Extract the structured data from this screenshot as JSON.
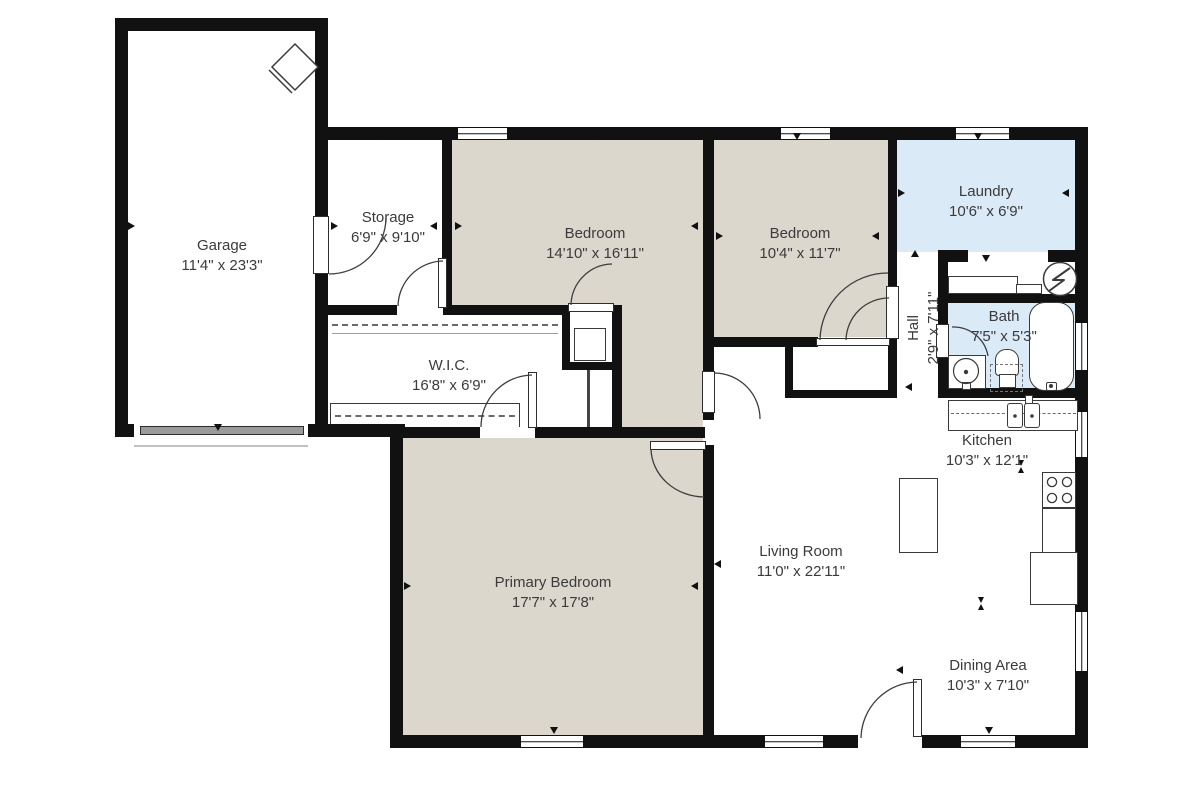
{
  "title": "Single-story house floor plan",
  "colors": {
    "wall": "#111111",
    "beige": "#dcd7cd",
    "blue": "#daeaf7",
    "text": "#3b3b3b",
    "garage-door": "#9a9a9a"
  },
  "rooms": [
    {
      "id": "garage",
      "name": "Garage",
      "dims": "11'4\" x 23'3\""
    },
    {
      "id": "storage",
      "name": "Storage",
      "dims": "6'9\" x 9'10\""
    },
    {
      "id": "bedroom1",
      "name": "Bedroom",
      "dims": "14'10\" x 16'11\""
    },
    {
      "id": "bedroom2",
      "name": "Bedroom",
      "dims": "10'4\" x 11'7\""
    },
    {
      "id": "laundry",
      "name": "Laundry",
      "dims": "10'6\" x 6'9\""
    },
    {
      "id": "hall",
      "name": "Hall",
      "dims": "2'9\" x 7'11\""
    },
    {
      "id": "bath",
      "name": "Bath",
      "dims": "7'5\" x 5'3\""
    },
    {
      "id": "wic",
      "name": "W.I.C.",
      "dims": "16'8\" x 6'9\""
    },
    {
      "id": "kitchen",
      "name": "Kitchen",
      "dims": "10'3\" x 12'1\""
    },
    {
      "id": "living",
      "name": "Living Room",
      "dims": "11'0\" x 22'11\""
    },
    {
      "id": "primary",
      "name": "Primary Bedroom",
      "dims": "17'7\" x 17'8\""
    },
    {
      "id": "dining",
      "name": "Dining Area",
      "dims": "10'3\" x 7'10\""
    }
  ],
  "icons": {
    "water_heater": "circle-with-lightning-bolt",
    "furnace": "rotated-square-diamond",
    "stove": "four-burner-cooktop",
    "sink": "double-basin-sink",
    "bathtub": "rounded-tub",
    "toilet": "tank-and-bowl",
    "vanity": "round-basin"
  }
}
